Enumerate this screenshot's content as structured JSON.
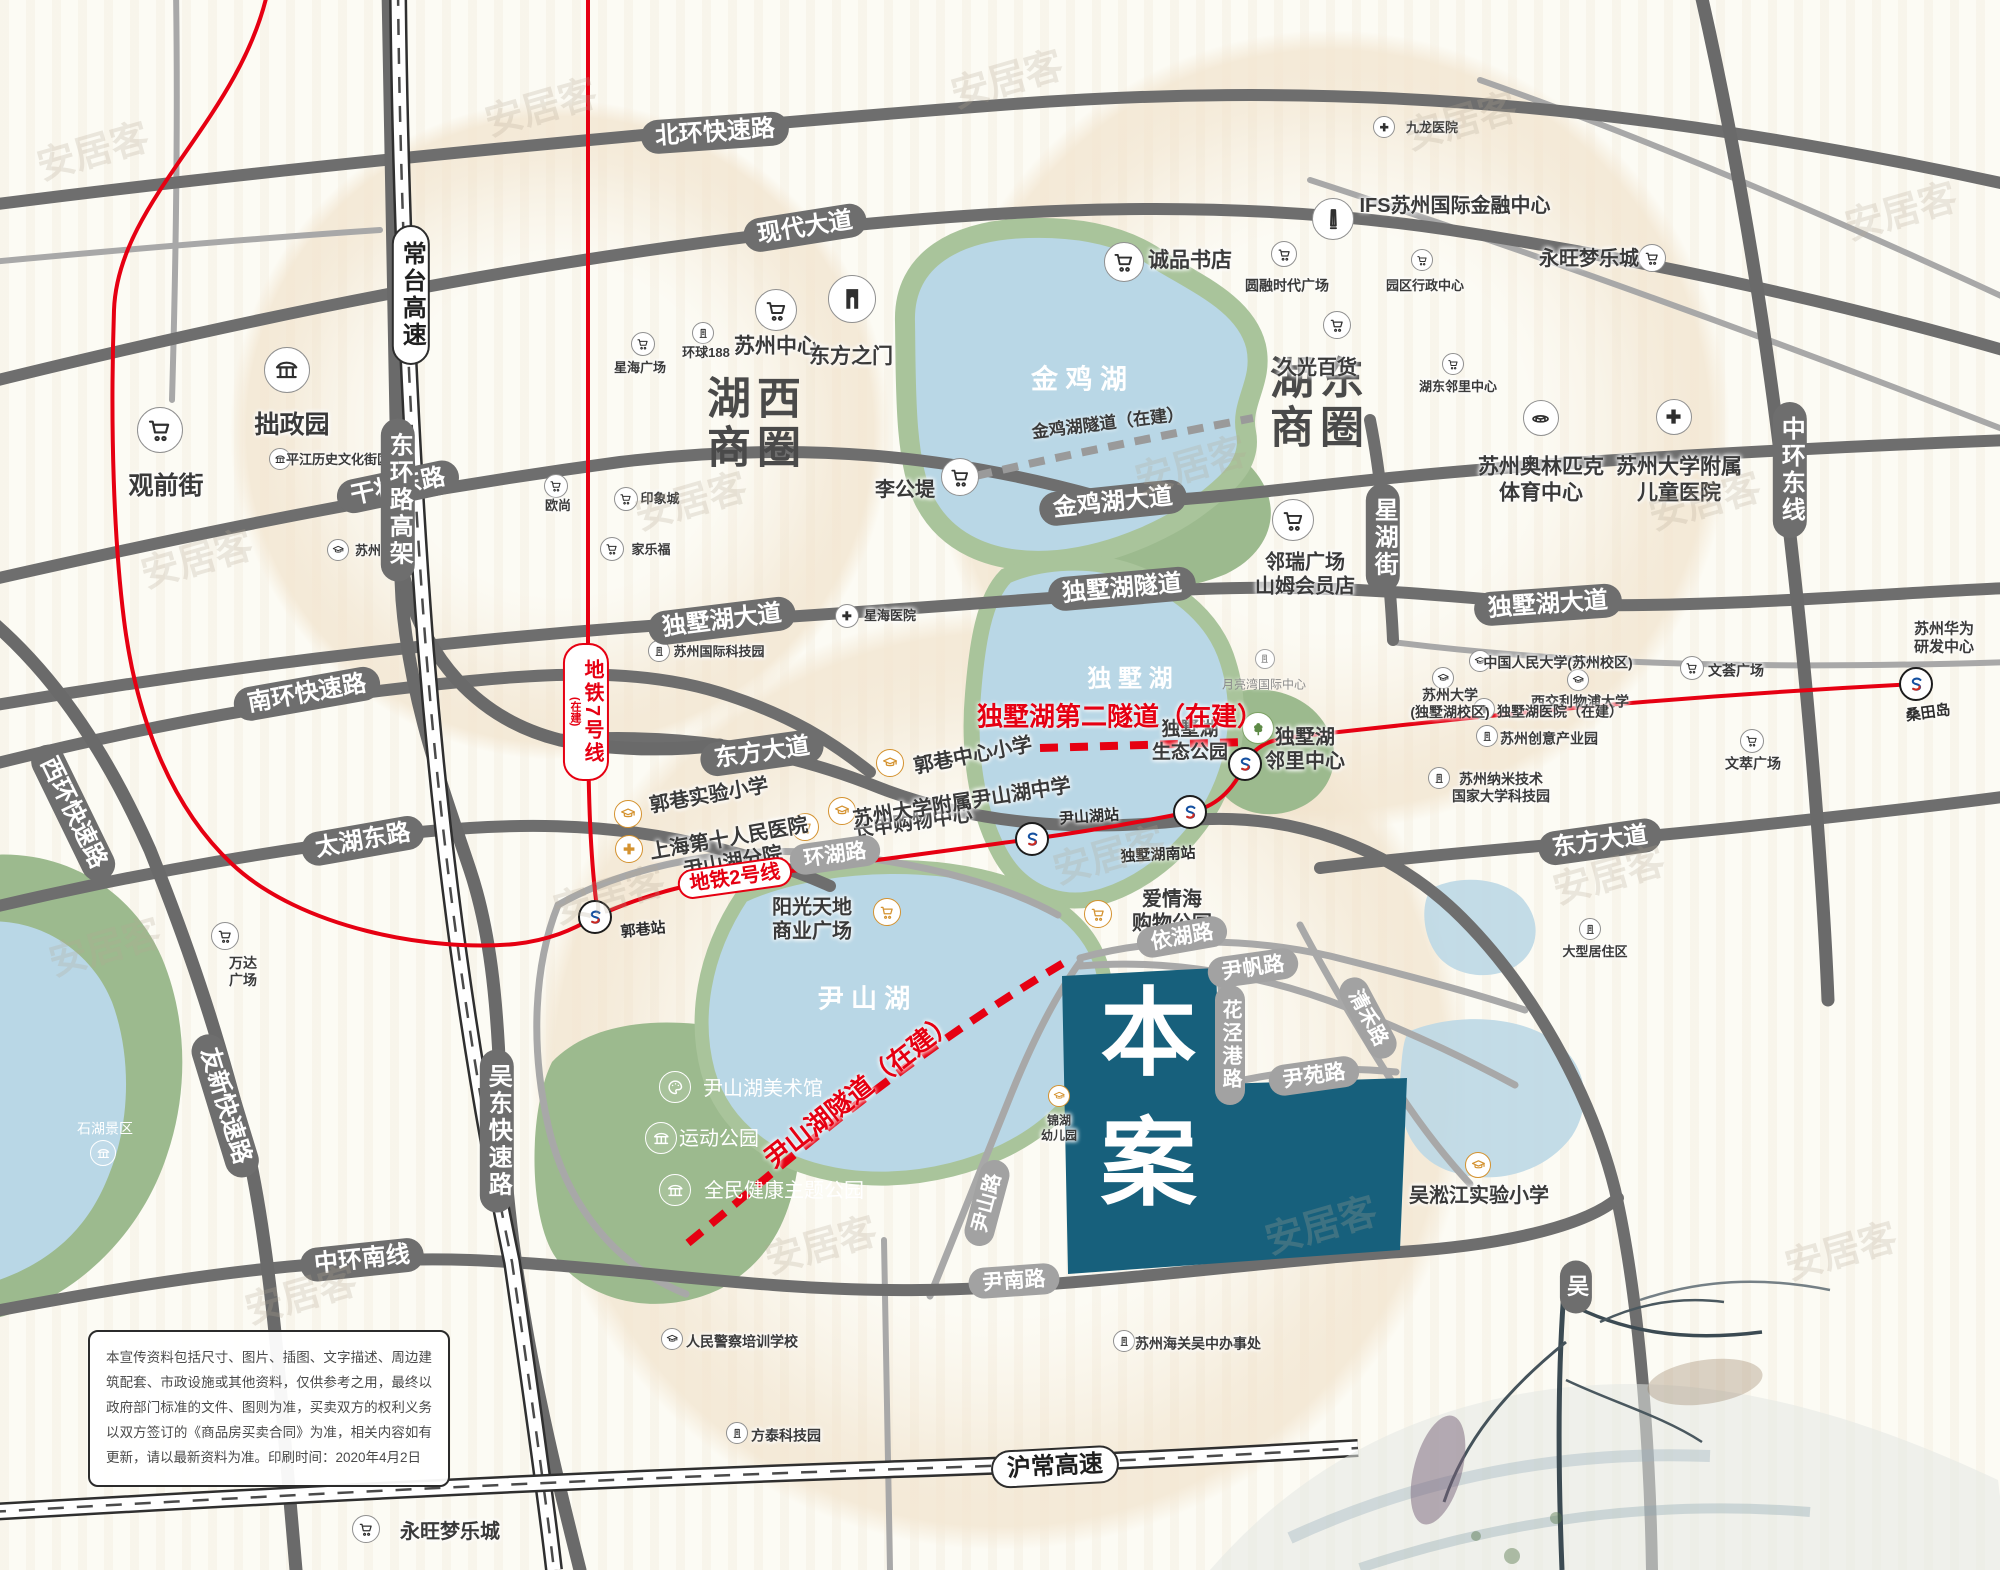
{
  "colors": {
    "accent_red": "#e60012",
    "road_dark": "#6e6e6e",
    "road_light": "#a2a2a2",
    "lake_blue": "#b9d7e6",
    "park_green": "#9cba8e",
    "site_teal": "#17607c",
    "halo_beige": "#efe0c8",
    "poi_orange": "#d4922f",
    "ink_dark": "#3b4a52"
  },
  "site": {
    "label": "本案"
  },
  "road_labels": [
    {
      "t": "北环快速路",
      "x": 715,
      "y": 133,
      "r": -4,
      "s": "d"
    },
    {
      "t": "现代大道",
      "x": 805,
      "y": 228,
      "r": -9,
      "s": "d"
    },
    {
      "t": "干将东路",
      "x": 398,
      "y": 487,
      "r": -12,
      "s": "d"
    },
    {
      "t": "金鸡湖大道",
      "x": 1113,
      "y": 503,
      "r": -6,
      "s": "d"
    },
    {
      "t": "独墅湖大道",
      "x": 722,
      "y": 621,
      "r": -7,
      "s": "d"
    },
    {
      "t": "独墅湖隧道",
      "x": 1122,
      "y": 589,
      "r": -5,
      "s": "d"
    },
    {
      "t": "独墅湖大道",
      "x": 1548,
      "y": 605,
      "r": -4,
      "s": "d"
    },
    {
      "t": "南环快速路",
      "x": 307,
      "y": 694,
      "r": -10,
      "s": "d"
    },
    {
      "t": "东方大道",
      "x": 762,
      "y": 753,
      "r": -8,
      "s": "d"
    },
    {
      "t": "东方大道",
      "x": 1600,
      "y": 842,
      "r": -8,
      "s": "d"
    },
    {
      "t": "太湖东路",
      "x": 363,
      "y": 841,
      "r": -10,
      "s": "d"
    },
    {
      "t": "环湖路",
      "x": 835,
      "y": 855,
      "r": -8,
      "s": "l",
      "fs": 21
    },
    {
      "t": "依湖路",
      "x": 1182,
      "y": 937,
      "r": -10,
      "s": "l",
      "fs": 21
    },
    {
      "t": "尹帆路",
      "x": 1253,
      "y": 968,
      "r": -8,
      "s": "l",
      "fs": 21
    },
    {
      "t": "尹苑路",
      "x": 1314,
      "y": 1076,
      "r": -8,
      "s": "l",
      "fs": 21
    },
    {
      "t": "尹南路",
      "x": 1014,
      "y": 1281,
      "r": -4,
      "s": "l",
      "fs": 21
    },
    {
      "t": "尹山路",
      "x": 987,
      "y": 1203,
      "r": -75,
      "s": "l",
      "fs": 20
    },
    {
      "t": "花泾港路",
      "x": 1230,
      "y": 1045,
      "s": "l",
      "v": 1,
      "fs": 20
    },
    {
      "t": "清禾路",
      "x": 1368,
      "y": 1018,
      "r": 62,
      "s": "l",
      "fs": 20
    },
    {
      "t": "中环南线",
      "x": 362,
      "y": 1260,
      "r": -6,
      "s": "d"
    },
    {
      "t": "沪常高速",
      "x": 1055,
      "y": 1467,
      "r": -3,
      "s": "hw"
    },
    {
      "t": "常台高速",
      "x": 411,
      "y": 295,
      "s": "hw",
      "v": 1
    },
    {
      "t": "东环路高架",
      "x": 398,
      "y": 500,
      "s": "d",
      "v": 1
    },
    {
      "t": "吴东快速路",
      "x": 497,
      "y": 1131,
      "s": "d",
      "v": 1
    },
    {
      "t": "中环东线",
      "x": 1790,
      "y": 470,
      "s": "d",
      "v": 1
    },
    {
      "t": "星湖街",
      "x": 1383,
      "y": 538,
      "s": "d",
      "v": 1
    },
    {
      "t": "吴",
      "x": 1576,
      "y": 1287,
      "s": "d",
      "v": 1,
      "fs": 22
    },
    {
      "t": "西环快速路",
      "x": 73,
      "y": 813,
      "r": 64,
      "s": "d"
    },
    {
      "t": "友新快速路",
      "x": 225,
      "y": 1106,
      "r": 73,
      "s": "d"
    },
    {
      "t": "地铁2号线",
      "x": 735,
      "y": 878,
      "r": -8,
      "s": "m",
      "fs": 20
    },
    {
      "t": "地铁7号线",
      "sub": "(在建)",
      "x": 586,
      "y": 712,
      "s": "m",
      "v": 1,
      "fs": 20
    },
    {
      "t": "金鸡湖隧道（在建）",
      "x": 1108,
      "y": 424,
      "r": -7,
      "s": "tg",
      "fs": 17
    },
    {
      "t": "独墅湖第二隧道（在建）",
      "x": 1120,
      "y": 717,
      "r": 0,
      "s": "tr",
      "fs": 26
    },
    {
      "t": "尹山湖隧道（在建）",
      "x": 860,
      "y": 1090,
      "r": -38,
      "s": "tr",
      "fs": 26
    }
  ],
  "area_labels": [
    {
      "lines": [
        "湖西",
        "商圈"
      ],
      "x": 757,
      "y": 424,
      "fs": 44,
      "c": "#4a4a4a"
    },
    {
      "lines": [
        "湖东",
        "商圈"
      ],
      "x": 1320,
      "y": 404,
      "fs": 44,
      "c": "#4a4a4a"
    },
    {
      "t": "金 鸡 湖",
      "x": 1079,
      "y": 377,
      "fs": 27,
      "lake": 1
    },
    {
      "t": "独 墅 湖",
      "x": 1130,
      "y": 676,
      "fs": 24,
      "lake": 1
    },
    {
      "t": "尹 山 湖",
      "x": 864,
      "y": 997,
      "fs": 26,
      "lake": 1
    }
  ],
  "pois": [
    {
      "t": "拙政园",
      "icon": "pav",
      "ix": 287,
      "iy": 370,
      "sz": 44,
      "lx": 292,
      "ly": 425,
      "fs": 25
    },
    {
      "t": "观前街",
      "icon": "cart",
      "ix": 160,
      "iy": 430,
      "sz": 44,
      "lx": 166,
      "ly": 486,
      "fs": 25
    },
    {
      "t": "平江历史文化街区",
      "icon": "pav",
      "ix": 280,
      "iy": 459,
      "sz": 20,
      "lx": 338,
      "ly": 460,
      "fs": 13
    },
    {
      "t": "苏州大学",
      "icon": "cap",
      "ix": 338,
      "iy": 550,
      "sz": 20,
      "lx": 381,
      "ly": 551,
      "fs": 13
    },
    {
      "t": "星海广场",
      "icon": "cart",
      "ix": 643,
      "iy": 344,
      "sz": 22,
      "lx": 640,
      "ly": 368,
      "fs": 13
    },
    {
      "t": "环球188",
      "icon": "bldg",
      "ix": 703,
      "iy": 333,
      "sz": 20,
      "lx": 706,
      "ly": 353,
      "fs": 13
    },
    {
      "t": "欧尚",
      "icon": "cart",
      "ix": 556,
      "iy": 486,
      "sz": 22,
      "lx": 558,
      "ly": 506,
      "fs": 13
    },
    {
      "t": "印象城",
      "icon": "cart",
      "ix": 626,
      "iy": 499,
      "sz": 22,
      "lx": 660,
      "ly": 499,
      "fs": 13
    },
    {
      "t": "家乐福",
      "icon": "cart",
      "ix": 612,
      "iy": 549,
      "sz": 22,
      "lx": 651,
      "ly": 550,
      "fs": 13
    },
    {
      "t": "苏州中心",
      "icon": "cart",
      "ix": 776,
      "iy": 310,
      "sz": 40,
      "lx": 776,
      "ly": 347,
      "fs": 21
    },
    {
      "t": "东方之门",
      "icon": "gate",
      "ix": 852,
      "iy": 299,
      "sz": 46,
      "lx": 851,
      "ly": 357,
      "fs": 21
    },
    {
      "t": "李公堤",
      "icon": "cart",
      "ix": 960,
      "iy": 477,
      "sz": 36,
      "lx": 905,
      "ly": 490,
      "fs": 20
    },
    {
      "t": "星海医院",
      "icon": "cross",
      "ix": 847,
      "iy": 616,
      "sz": 22,
      "lx": 890,
      "ly": 616,
      "fs": 13
    },
    {
      "t": "苏州国际科技园",
      "icon": "bldg",
      "ix": 659,
      "iy": 651,
      "sz": 20,
      "lx": 719,
      "ly": 652,
      "fs": 13
    },
    {
      "t": "诚品书店",
      "icon": "cart",
      "ix": 1124,
      "iy": 262,
      "sz": 38,
      "lx": 1190,
      "ly": 261,
      "fs": 21
    },
    {
      "t": "圆融时代广场",
      "icon": "cart",
      "ix": 1284,
      "iy": 254,
      "sz": 24,
      "lx": 1287,
      "ly": 286,
      "fs": 14
    },
    {
      "t": "IFS苏州国际金融中心",
      "icon": "tower",
      "ix": 1333,
      "iy": 219,
      "sz": 40,
      "lx": 1455,
      "ly": 206,
      "fs": 20
    },
    {
      "t": "九龙医院",
      "icon": "cross",
      "ix": 1384,
      "iy": 127,
      "sz": 20,
      "lx": 1432,
      "ly": 128,
      "fs": 13
    },
    {
      "t": "园区行政中心",
      "icon": "cart",
      "ix": 1422,
      "iy": 260,
      "sz": 20,
      "lx": 1425,
      "ly": 286,
      "fs": 13
    },
    {
      "t": "永旺梦乐城",
      "icon": "cart",
      "ix": 1652,
      "iy": 258,
      "sz": 26,
      "lx": 1589,
      "ly": 259,
      "fs": 20
    },
    {
      "t": "久光百货",
      "icon": "cart",
      "ix": 1337,
      "iy": 325,
      "sz": 26,
      "lx": 1317,
      "ly": 368,
      "fs": 20
    },
    {
      "t": "湖东邻里中心",
      "icon": "cart",
      "ix": 1453,
      "iy": 364,
      "sz": 20,
      "lx": 1458,
      "ly": 387,
      "fs": 13
    },
    {
      "lines": [
        "苏州奥林匹克",
        "体育中心"
      ],
      "icon": "stad",
      "ix": 1541,
      "iy": 418,
      "sz": 34,
      "lx": 1541,
      "ly": 480,
      "fs": 21
    },
    {
      "lines": [
        "苏州大学附属",
        "儿童医院"
      ],
      "icon": "cross",
      "ix": 1674,
      "iy": 417,
      "sz": 34,
      "lx": 1679,
      "ly": 480,
      "fs": 21
    },
    {
      "lines": [
        "邻瑞广场",
        "山姆会员店"
      ],
      "icon": "cart",
      "ix": 1293,
      "iy": 520,
      "sz": 40,
      "lx": 1305,
      "ly": 575,
      "fs": 20
    },
    {
      "t": "月亮湾国际中心",
      "icon": "bldg",
      "ix": 1265,
      "iy": 659,
      "sz": 18,
      "lx": 1264,
      "ly": 685,
      "fs": 12,
      "c": "gy"
    },
    {
      "t": "中国人民大学(苏州校区)",
      "icon": "cap",
      "ix": 1480,
      "iy": 661,
      "sz": 20,
      "lx": 1558,
      "ly": 663,
      "fs": 14
    },
    {
      "lines": [
        "苏州大学",
        "(独墅湖校区)"
      ],
      "icon": "cap",
      "ix": 1443,
      "iy": 678,
      "sz": 20,
      "lx": 1450,
      "ly": 704,
      "fs": 14
    },
    {
      "t": "西交利物浦大学",
      "icon": "cap",
      "ix": 1578,
      "iy": 680,
      "sz": 20,
      "lx": 1580,
      "ly": 702,
      "fs": 14
    },
    {
      "t": "独墅湖医院（在建）",
      "icon": "cross",
      "ix": 1484,
      "iy": 709,
      "sz": 20,
      "lx": 1560,
      "ly": 712,
      "fs": 14
    },
    {
      "t": "苏州创意产业园",
      "icon": "bldg",
      "ix": 1487,
      "iy": 736,
      "sz": 20,
      "lx": 1549,
      "ly": 739,
      "fs": 14
    },
    {
      "lines": [
        "苏州纳米技术",
        "国家大学科技园"
      ],
      "icon": "bldg",
      "ix": 1439,
      "iy": 778,
      "sz": 20,
      "lx": 1501,
      "ly": 788,
      "fs": 14
    },
    {
      "t": "文荟广场",
      "icon": "cart",
      "ix": 1692,
      "iy": 668,
      "sz": 22,
      "lx": 1736,
      "ly": 671,
      "fs": 14
    },
    {
      "t": "文萃广场",
      "icon": "cart",
      "ix": 1752,
      "iy": 741,
      "sz": 22,
      "lx": 1753,
      "ly": 764,
      "fs": 14
    },
    {
      "lines": [
        "苏州华为",
        "研发中心"
      ],
      "lx": 1944,
      "ly": 639,
      "fs": 15
    },
    {
      "lines": [
        "独墅湖",
        "生态公园"
      ],
      "icon": "tree",
      "ix": 1258,
      "iy": 728,
      "sz": 30,
      "lx": 1190,
      "ly": 741,
      "fs": 19,
      "c": "gr"
    },
    {
      "lines": [
        "独墅湖",
        "邻里中心"
      ],
      "lx": 1305,
      "ly": 750,
      "fs": 20
    },
    {
      "t": "大型居住区",
      "icon": "bldg",
      "ix": 1590,
      "iy": 929,
      "sz": 20,
      "lx": 1595,
      "ly": 952,
      "fs": 13
    },
    {
      "t": "吴淞江实验小学",
      "icon": "cap",
      "ix": 1478,
      "iy": 1165,
      "sz": 24,
      "lx": 1479,
      "ly": 1196,
      "fs": 20,
      "c": "or"
    },
    {
      "lines": [
        "锦湖",
        "幼儿园"
      ],
      "icon": "cap",
      "ix": 1059,
      "iy": 1096,
      "sz": 20,
      "lx": 1059,
      "ly": 1128,
      "fs": 12,
      "c": "or"
    },
    {
      "t": "郭巷实验小学",
      "icon": "cap",
      "ix": 628,
      "iy": 814,
      "sz": 26,
      "lx": 709,
      "ly": 796,
      "fs": 20,
      "lr": -10,
      "c": "or"
    },
    {
      "lines": [
        "上海第十人民医院",
        "尹山湖分院"
      ],
      "icon": "cross",
      "ix": 629,
      "iy": 849,
      "sz": 26,
      "lx": 731,
      "ly": 851,
      "fs": 20,
      "lr": -10,
      "c": "or"
    },
    {
      "t": "长申购物中心",
      "icon": "cart",
      "ix": 805,
      "iy": 827,
      "sz": 26,
      "lx": 913,
      "ly": 823,
      "fs": 20,
      "lr": -8,
      "c": "or"
    },
    {
      "t": "郭巷中心小学",
      "icon": "cap",
      "ix": 890,
      "iy": 763,
      "sz": 26,
      "lx": 973,
      "ly": 756,
      "fs": 20,
      "lr": -11,
      "c": "or"
    },
    {
      "t": "苏州大学附属尹山湖中学",
      "icon": "cap",
      "ix": 842,
      "iy": 811,
      "sz": 26,
      "lx": 962,
      "ly": 803,
      "fs": 20,
      "lr": -9,
      "c": "or"
    },
    {
      "lines": [
        "阳光天地",
        "商业广场"
      ],
      "icon": "cart",
      "ix": 887,
      "iy": 912,
      "sz": 26,
      "lx": 812,
      "ly": 920,
      "fs": 20,
      "c": "or"
    },
    {
      "lines": [
        "爱情海",
        "购物公园"
      ],
      "icon": "cart",
      "ix": 1098,
      "iy": 914,
      "sz": 26,
      "lx": 1172,
      "ly": 912,
      "fs": 20,
      "c": "or"
    },
    {
      "t": "尹山湖美术馆",
      "icon": "pal",
      "ix": 675,
      "iy": 1087,
      "sz": 30,
      "lx": 763,
      "ly": 1089,
      "fs": 20,
      "c": "wh"
    },
    {
      "t": "运动公园",
      "icon": "pav",
      "ix": 661,
      "iy": 1138,
      "sz": 30,
      "lx": 719,
      "ly": 1139,
      "fs": 20,
      "c": "wh"
    },
    {
      "t": "全民健康主题公园",
      "icon": "pav",
      "ix": 675,
      "iy": 1190,
      "sz": 30,
      "lx": 784,
      "ly": 1191,
      "fs": 20,
      "c": "wh"
    },
    {
      "t": "石湖景区",
      "icon": "pav",
      "ix": 103,
      "iy": 1153,
      "sz": 24,
      "lx": 105,
      "ly": 1129,
      "fs": 14,
      "c": "wh"
    },
    {
      "lines": [
        "万达",
        "广场"
      ],
      "icon": "cart",
      "ix": 225,
      "iy": 936,
      "sz": 26,
      "lx": 243,
      "ly": 972,
      "fs": 14
    },
    {
      "t": "人民警察培训学校",
      "icon": "cap",
      "ix": 672,
      "iy": 1339,
      "sz": 20,
      "lx": 742,
      "ly": 1342,
      "fs": 14
    },
    {
      "t": "方泰科技园",
      "icon": "bldg",
      "ix": 737,
      "iy": 1433,
      "sz": 20,
      "lx": 786,
      "ly": 1436,
      "fs": 14
    },
    {
      "t": "苏州海关吴中办事处",
      "icon": "bldg",
      "ix": 1124,
      "iy": 1341,
      "sz": 20,
      "lx": 1198,
      "ly": 1344,
      "fs": 14
    },
    {
      "t": "永旺梦乐城",
      "icon": "cart",
      "ix": 366,
      "iy": 1529,
      "sz": 26,
      "lx": 450,
      "ly": 1532,
      "fs": 20
    }
  ],
  "stations": [
    {
      "x": 595,
      "y": 917,
      "t": "郭巷站",
      "lx": 643,
      "ly": 929,
      "r": -6
    },
    {
      "x": 1032,
      "y": 839,
      "t": "尹山湖站",
      "lx": 1089,
      "ly": 816,
      "r": -4
    },
    {
      "x": 1190,
      "y": 812,
      "t": "独墅湖南站",
      "lx": 1158,
      "ly": 854,
      "r": -3
    },
    {
      "x": 1245,
      "y": 764
    },
    {
      "x": 1916,
      "y": 684,
      "t": "桑田岛",
      "lx": 1928,
      "ly": 712,
      "r": -8
    }
  ],
  "watermark": {
    "text": "安居客",
    "spots": [
      [
        92,
        148
      ],
      [
        540,
        104
      ],
      [
        1006,
        76
      ],
      [
        1460,
        118
      ],
      [
        1900,
        208
      ],
      [
        196,
        556
      ],
      [
        690,
        498
      ],
      [
        1190,
        462
      ],
      [
        1704,
        498
      ],
      [
        104,
        944
      ],
      [
        608,
        892
      ],
      [
        1108,
        852
      ],
      [
        1608,
        872
      ],
      [
        300,
        1292
      ],
      [
        820,
        1242
      ],
      [
        1320,
        1222
      ],
      [
        1840,
        1248
      ]
    ]
  },
  "disclaimer": {
    "text": "本宣传资料包括尺寸、图片、插图、文字描述、周边建筑配套、市政设施或其他资料，仅供参考之用，最终以政府部门标准的文件、图则为准，买卖双方的权利义务以双方签订的《商品房买卖合同》为准，相关内容如有更新，请以最新资料为准。印刷时间：2020年4月2日"
  }
}
